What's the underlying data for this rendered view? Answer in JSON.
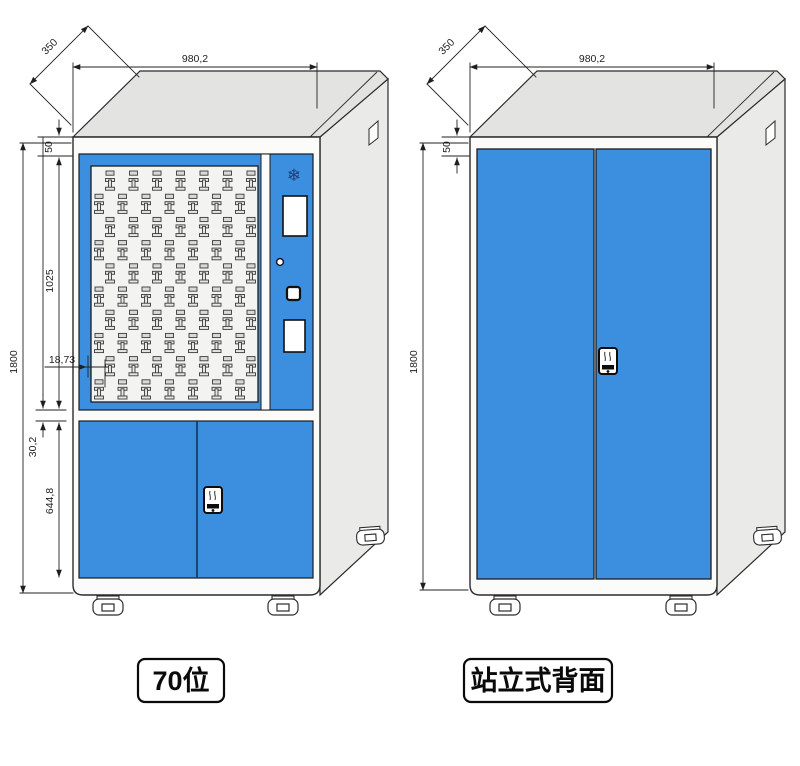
{
  "drawing": {
    "type": "technical-drawing",
    "subject": "key-cabinet",
    "views": {
      "front": {
        "caption": "70位",
        "dims": {
          "depth": "350",
          "width": "980,2",
          "top_trim": "50",
          "upper_section_height": "1025",
          "key_inset": "18,73",
          "total_height": "1800",
          "mid_gap": "30,2",
          "lower_section_height": "644,8"
        },
        "key_grid": {
          "rows": 10,
          "columns": 7,
          "total_positions": 70
        }
      },
      "rear": {
        "caption": "站立式背面",
        "dims": {
          "depth": "350",
          "width": "980,2",
          "top_trim": "50",
          "total_height": "1800"
        }
      }
    },
    "icons": {
      "snowflake": "❄"
    },
    "colors": {
      "door_blue": "#3c8ede",
      "panel_gray": "#f3f3f1",
      "top_gray": "#e3e3e1",
      "side_gray": "#eaeae8",
      "line_dark": "#1c1c1c"
    }
  }
}
